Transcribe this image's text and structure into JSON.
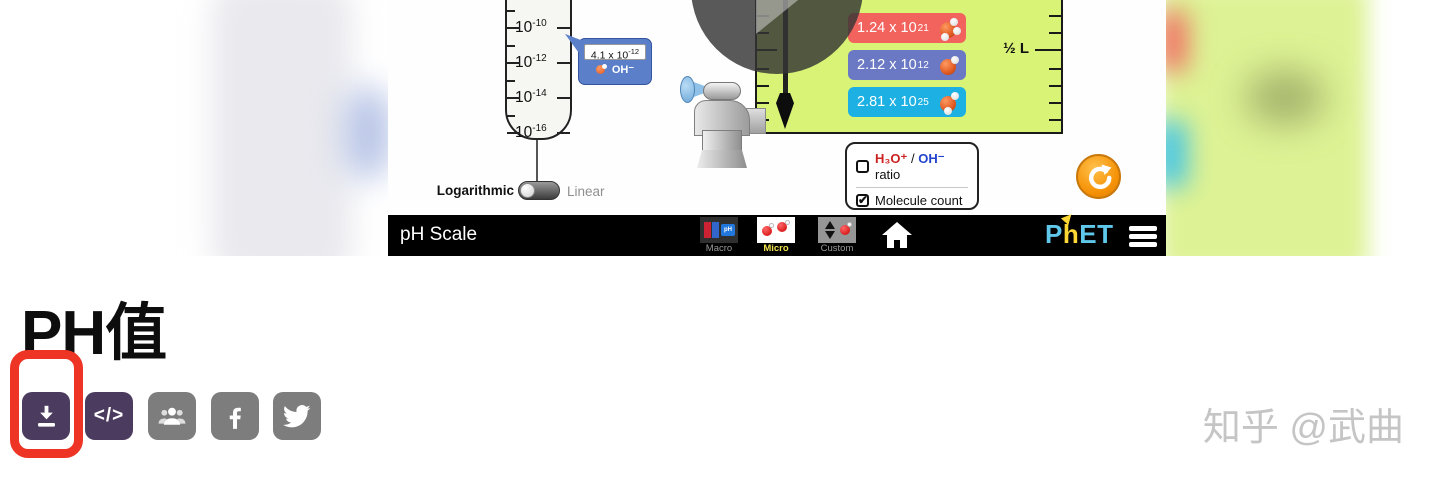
{
  "sim": {
    "scale": {
      "top_partial": {
        "base": "10",
        "exp": "-8"
      },
      "ticks": [
        {
          "base": "10",
          "exp": "-10"
        },
        {
          "base": "10",
          "exp": "-12"
        },
        {
          "base": "10",
          "exp": "-14"
        },
        {
          "base": "10",
          "exp": "-16"
        }
      ],
      "tooltip": {
        "value": "4.1 x 10",
        "exp": "-12",
        "ion": "OH⁻"
      },
      "toggle_left": "Logarithmic",
      "toggle_right": "Linear"
    },
    "beaker": {
      "volume_label": "½ L",
      "badges": [
        {
          "value": "1.24 x 10",
          "exp": "21"
        },
        {
          "value": "2.12 x 10",
          "exp": "12"
        },
        {
          "value": "2.81 x 10",
          "exp": "25"
        }
      ]
    },
    "controls": {
      "ratio_h3o": "H₃O⁺",
      "ratio_sep": " / ",
      "ratio_oh": "OH⁻",
      "ratio_rest": " ratio",
      "count_label": "Molecule count",
      "check_glyph": "✔"
    },
    "navbar": {
      "title": "pH Scale",
      "tab_macro": "Macro",
      "tab_micro": "Micro",
      "tab_custom": "Custom",
      "macro_ph": "pH",
      "logo_p": "P",
      "logo_h": "h",
      "logo_et": "ET"
    }
  },
  "article": {
    "title": "PH值",
    "embed_label": "</>",
    "watermark": "知乎 @武曲"
  },
  "colors": {
    "badge_red": "#f2635e",
    "badge_blue": "#6b79c4",
    "badge_cyan": "#1cb1e2",
    "beaker_green": "#d9f377",
    "accent_purple": "#4b3c5f",
    "icon_gray": "#7d7d7d",
    "highlight_red": "#ee3424",
    "reset_orange": "#f59105",
    "phet_blue": "#5ec7ea",
    "phet_yellow": "#fdd835",
    "selected_tab_yellow": "#f2e24c"
  }
}
